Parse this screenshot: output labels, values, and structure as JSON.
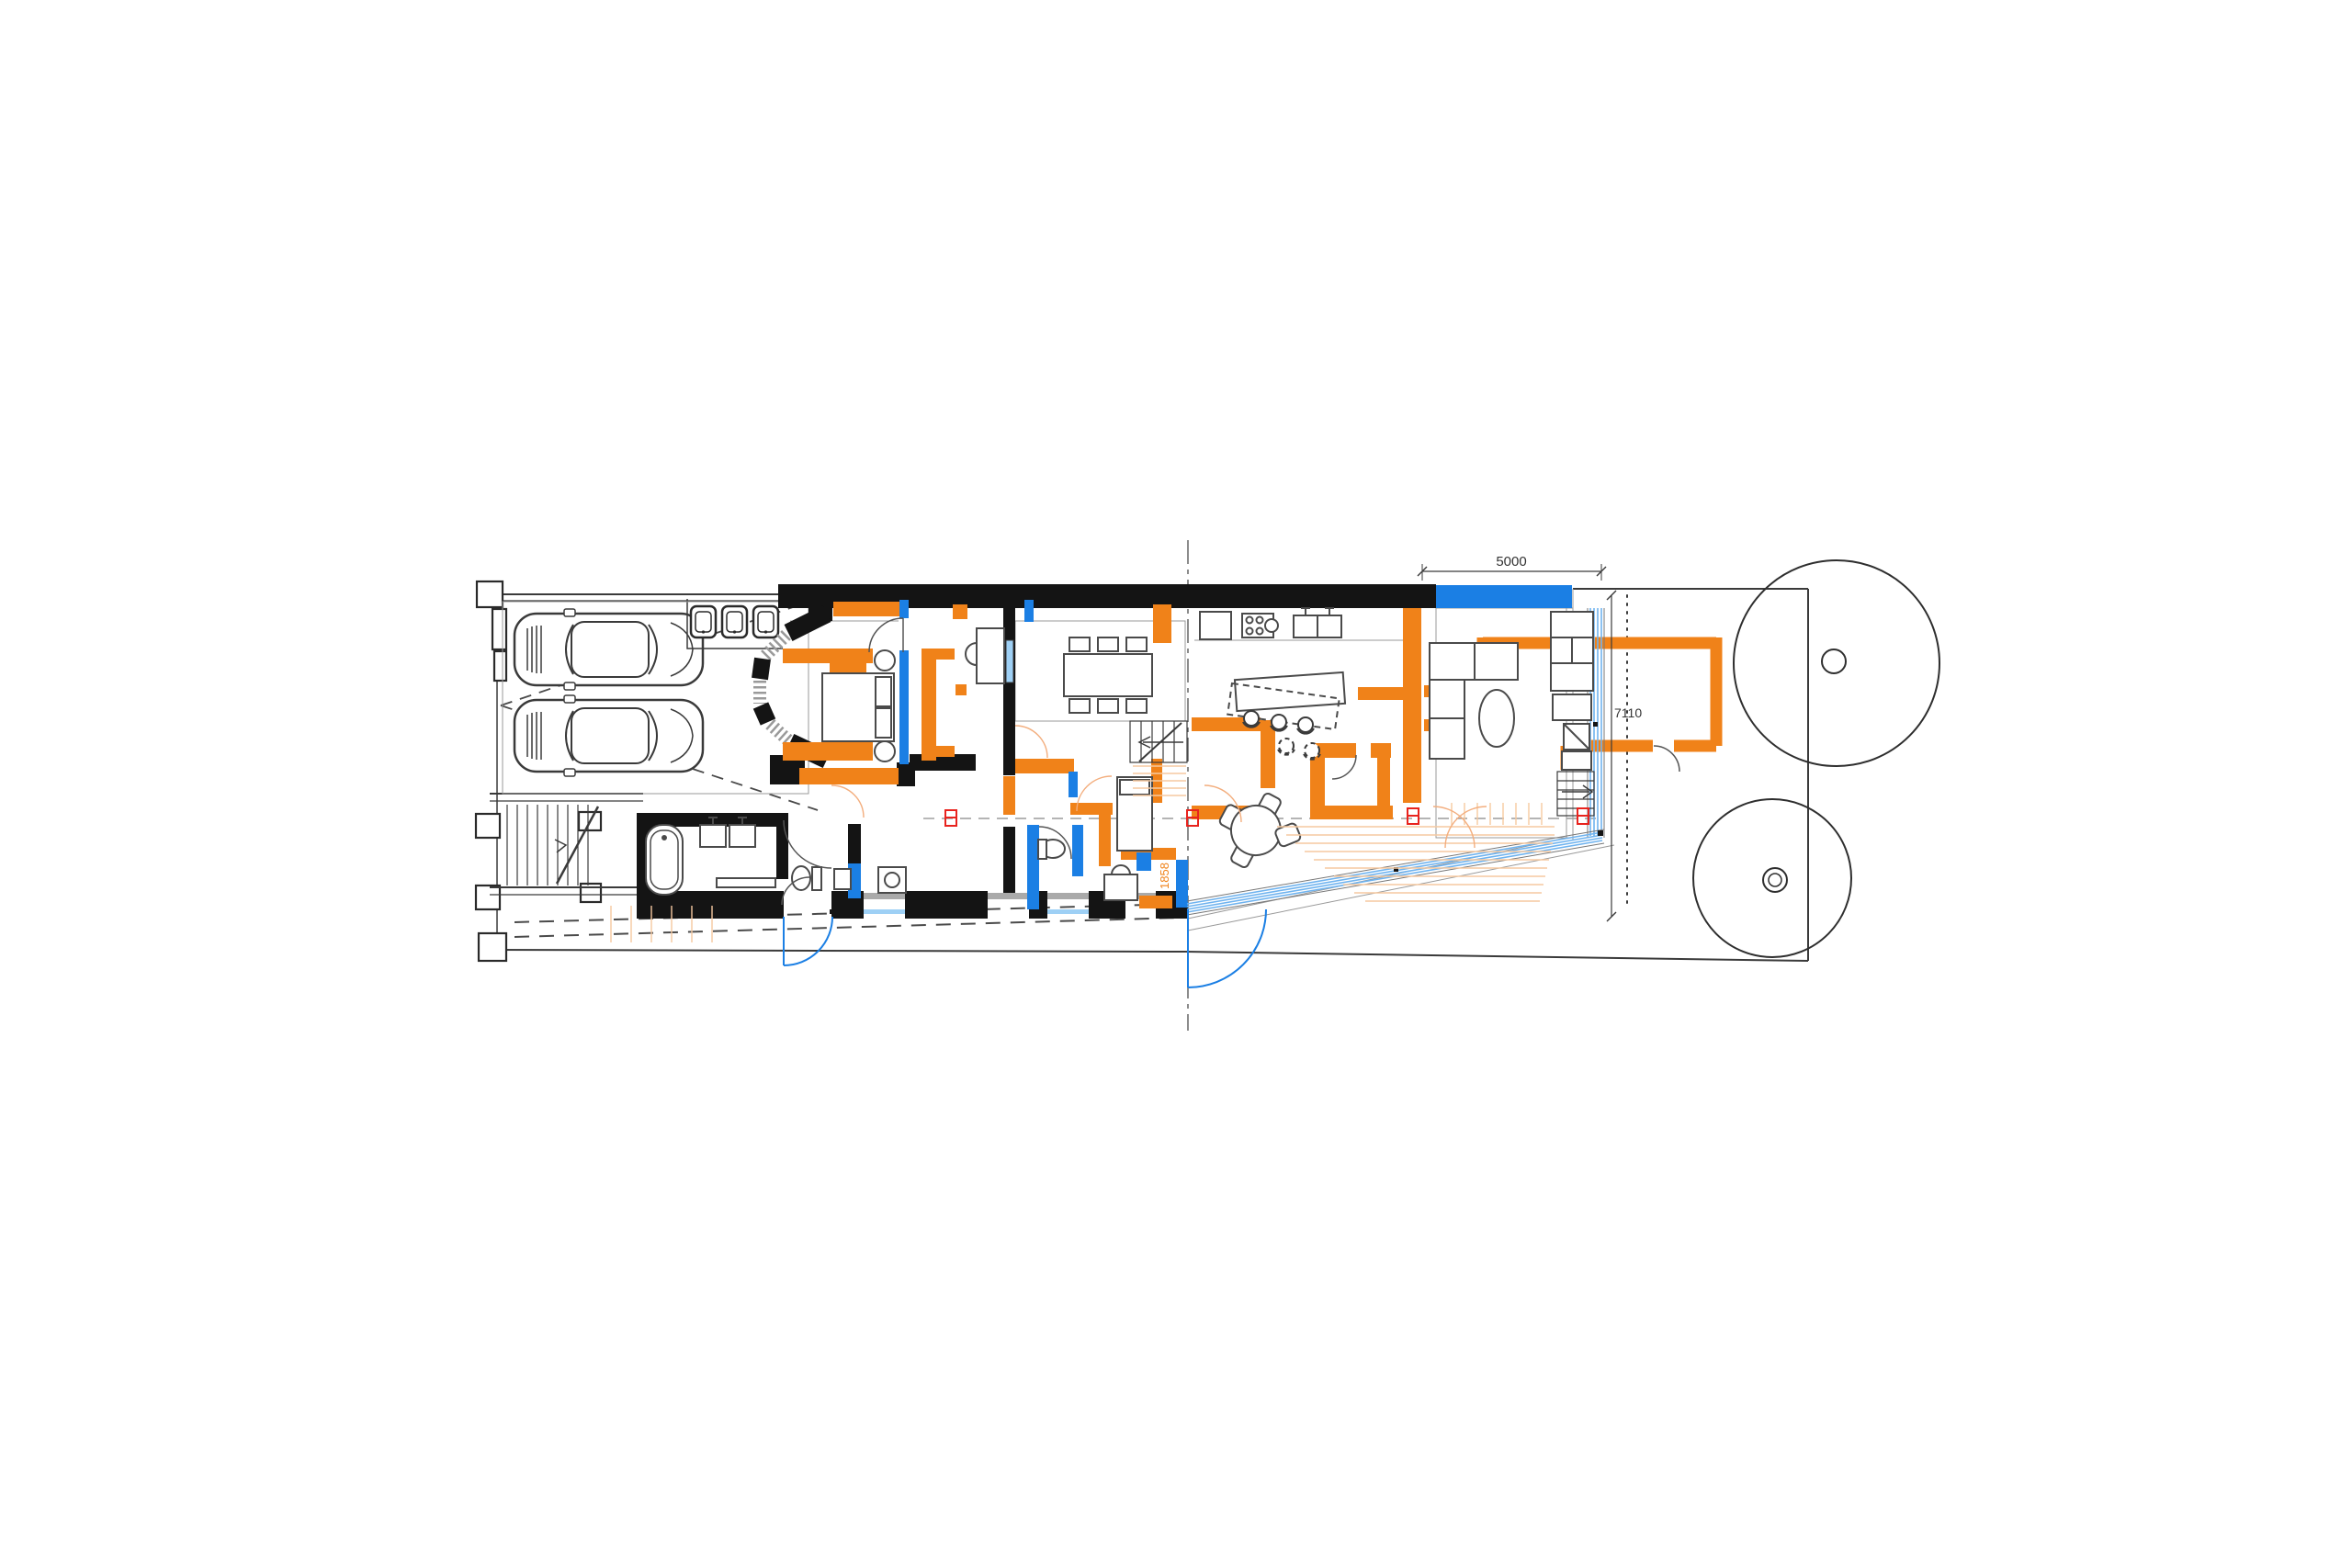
{
  "document": {
    "type": "architectural-floor-plan",
    "view": "ground-floor-plan-with-proposed-works"
  },
  "dimensions": {
    "top_extension_width": "5000",
    "side_extension_depth": "7110",
    "entry_opening": "1858"
  },
  "colors": {
    "existing_wall": "#141414",
    "proposed_orange": "#F08219",
    "proposed_blue": "#1B7FE4",
    "glazing_blue": "#6FB3EF",
    "faint_orange": "#F3AE7E",
    "marker_red": "#E8231E",
    "line_dark": "#3A3A3A",
    "line_light": "#999999"
  },
  "legend_semantics": {
    "black": "existing walls",
    "orange": "proposed joinery / new walls",
    "blue": "new partition walls",
    "light_blue": "new glazing"
  }
}
